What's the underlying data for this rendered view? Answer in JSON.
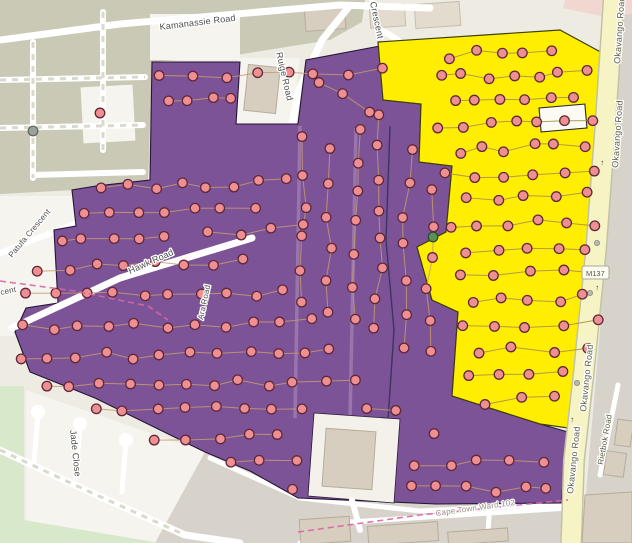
{
  "map": {
    "labels": {
      "kamanassie_road": "Kamanassie Road",
      "ruige_road": "Ruige Road",
      "crescent_partial": "Crescent",
      "hawk_road": "Hawk Road",
      "ara_road": "Ara Road",
      "patufa_crescent": "Patufa Crescent",
      "crescent_fragment": "cent",
      "jade_close": "Jade Close",
      "ward_boundary": "Cape Town Ward 102",
      "okavango_road": "Okavango Road",
      "route_shield": "M137",
      "rietbok_road": "Rietbok Road",
      "oneway_arrow": "↑"
    },
    "colors": {
      "purple_zone": "#7d5398",
      "purple_outline": "#241536",
      "yellow_zone": "#ffee00",
      "yellow_outline": "#3f3f0a",
      "dot_fill": "#ef8f92",
      "dot_stroke": "#5f2839",
      "major_road_fill": "#f6f3c4",
      "major_road_casing": "#c2c2a8",
      "boundary_dash": "#d965a5",
      "connector": "#c59b6e",
      "label_color": "#4d4d4d"
    },
    "dot_rows": [
      {
        "x1": 162,
        "y1": 78,
        "x2": 378,
        "y2": 70,
        "n": 8,
        "zone": "purple"
      },
      {
        "x1": 168,
        "y1": 103,
        "x2": 232,
        "y2": 100,
        "n": 4,
        "zone": "purple"
      },
      {
        "x1": 315,
        "y1": 82,
        "x2": 372,
        "y2": 112,
        "n": 3,
        "zone": "purple"
      },
      {
        "x1": 100,
        "y1": 188,
        "x2": 290,
        "y2": 182,
        "n": 8,
        "zone": "purple"
      },
      {
        "x1": 82,
        "y1": 213,
        "x2": 252,
        "y2": 208,
        "n": 7,
        "zone": "purple"
      },
      {
        "x1": 58,
        "y1": 240,
        "x2": 162,
        "y2": 236,
        "n": 5,
        "zone": "purple"
      },
      {
        "x1": 205,
        "y1": 233,
        "x2": 302,
        "y2": 228,
        "n": 4,
        "zone": "purple"
      },
      {
        "x1": 38,
        "y1": 268,
        "x2": 242,
        "y2": 262,
        "n": 8,
        "zone": "purple"
      },
      {
        "x1": 28,
        "y1": 297,
        "x2": 286,
        "y2": 292,
        "n": 10,
        "zone": "purple"
      },
      {
        "x1": 22,
        "y1": 327,
        "x2": 310,
        "y2": 322,
        "n": 11,
        "zone": "purple"
      },
      {
        "x1": 20,
        "y1": 357,
        "x2": 332,
        "y2": 352,
        "n": 12,
        "zone": "purple"
      },
      {
        "x1": 44,
        "y1": 386,
        "x2": 352,
        "y2": 382,
        "n": 12,
        "zone": "purple"
      },
      {
        "x1": 96,
        "y1": 412,
        "x2": 392,
        "y2": 408,
        "n": 11,
        "zone": "purple"
      },
      {
        "x1": 156,
        "y1": 438,
        "x2": 432,
        "y2": 434,
        "n": 10,
        "zone": "purple"
      },
      {
        "x1": 232,
        "y1": 464,
        "x2": 540,
        "y2": 461,
        "n": 11,
        "zone": "purple"
      },
      {
        "x1": 296,
        "y1": 490,
        "x2": 550,
        "y2": 488,
        "n": 10,
        "zone": "purple"
      },
      {
        "x1": 305,
        "y1": 140,
        "x2": 300,
        "y2": 305,
        "n": 6,
        "zone": "purple"
      },
      {
        "x1": 330,
        "y1": 150,
        "x2": 326,
        "y2": 310,
        "n": 6,
        "zone": "purple"
      },
      {
        "x1": 356,
        "y1": 128,
        "x2": 352,
        "y2": 318,
        "n": 7,
        "zone": "purple"
      },
      {
        "x1": 382,
        "y1": 118,
        "x2": 378,
        "y2": 330,
        "n": 8,
        "zone": "purple"
      },
      {
        "x1": 408,
        "y1": 148,
        "x2": 404,
        "y2": 345,
        "n": 7,
        "zone": "purple"
      },
      {
        "x1": 432,
        "y1": 192,
        "x2": 428,
        "y2": 350,
        "n": 6,
        "zone": "purple"
      },
      {
        "x1": 448,
        "y1": 55,
        "x2": 552,
        "y2": 48,
        "n": 5,
        "zone": "yellow"
      },
      {
        "x1": 438,
        "y1": 78,
        "x2": 585,
        "y2": 72,
        "n": 7,
        "zone": "yellow"
      },
      {
        "x1": 452,
        "y1": 102,
        "x2": 578,
        "y2": 98,
        "n": 6,
        "zone": "yellow"
      },
      {
        "x1": 442,
        "y1": 126,
        "x2": 590,
        "y2": 122,
        "n": 7,
        "zone": "yellow"
      },
      {
        "x1": 458,
        "y1": 150,
        "x2": 582,
        "y2": 146,
        "n": 6,
        "zone": "yellow"
      },
      {
        "x1": 448,
        "y1": 175,
        "x2": 592,
        "y2": 172,
        "n": 6,
        "zone": "yellow"
      },
      {
        "x1": 465,
        "y1": 200,
        "x2": 585,
        "y2": 196,
        "n": 5,
        "zone": "yellow"
      },
      {
        "x1": 452,
        "y1": 225,
        "x2": 595,
        "y2": 222,
        "n": 6,
        "zone": "yellow"
      },
      {
        "x1": 470,
        "y1": 250,
        "x2": 588,
        "y2": 248,
        "n": 5,
        "zone": "yellow"
      },
      {
        "x1": 458,
        "y1": 275,
        "x2": 595,
        "y2": 272,
        "n": 5,
        "zone": "yellow"
      },
      {
        "x1": 472,
        "y1": 300,
        "x2": 586,
        "y2": 298,
        "n": 5,
        "zone": "yellow"
      },
      {
        "x1": 462,
        "y1": 325,
        "x2": 594,
        "y2": 322,
        "n": 5,
        "zone": "yellow"
      },
      {
        "x1": 475,
        "y1": 350,
        "x2": 588,
        "y2": 348,
        "n": 4,
        "zone": "yellow"
      },
      {
        "x1": 468,
        "y1": 378,
        "x2": 560,
        "y2": 375,
        "n": 4,
        "zone": "yellow"
      },
      {
        "x1": 485,
        "y1": 402,
        "x2": 552,
        "y2": 400,
        "n": 3,
        "zone": "yellow"
      }
    ],
    "single_markers": {
      "pink": [
        [
          100,
          113
        ]
      ],
      "green": [
        [
          433,
          237
        ]
      ],
      "grey": [
        [
          33,
          131
        ]
      ]
    }
  }
}
